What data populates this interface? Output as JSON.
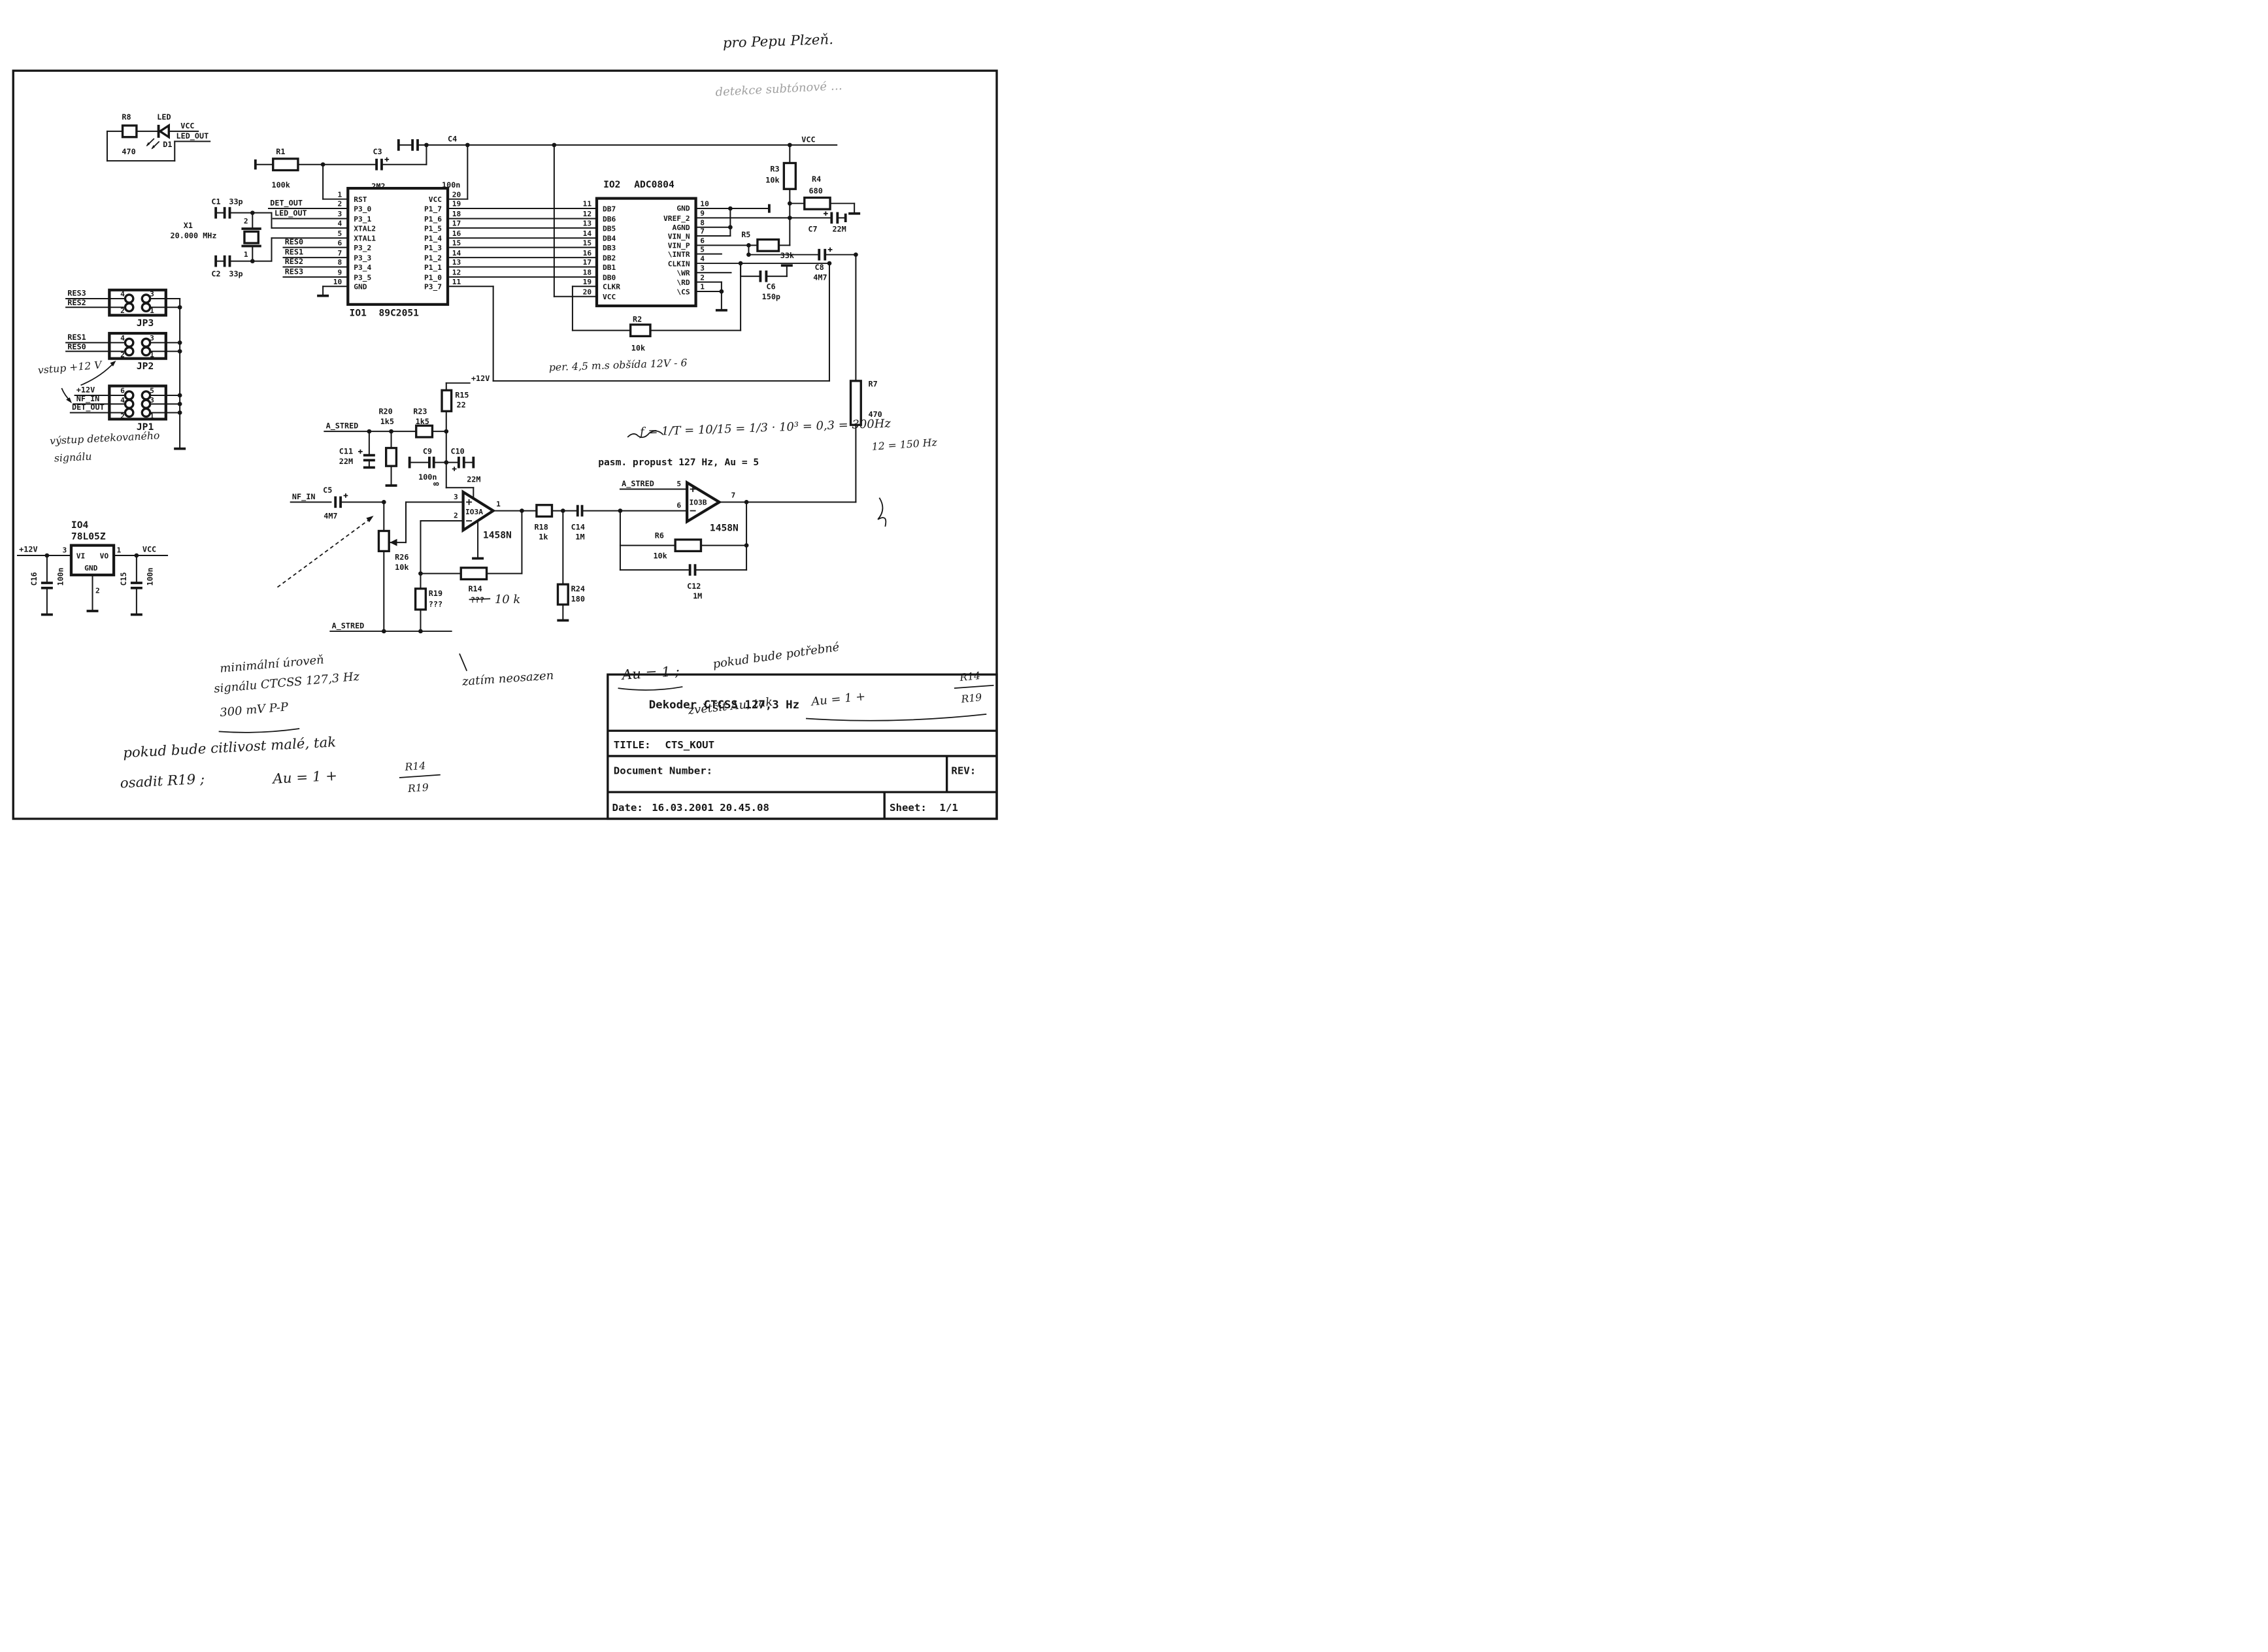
{
  "printed": {
    "bandpass_note": "pasm. propust 127 Hz, Au = 5"
  },
  "handwritten": {
    "dedication": "pro Pepu Plzeň.",
    "note_top": "detekce subtónové …",
    "timing": "per. 4,5 m.s    obšída 12V - 6",
    "formula": "f = 1/T = 10/15 = 1/3 · 10³ = 0,3 = 300Hz",
    "freq": "12 = 150 Hz",
    "r14_value": "10 k",
    "not_fitted": "zatím neosazen",
    "gain1": "Au = 1 ;",
    "gain2": "pokud bude potřebné",
    "gain3": "zvětšit Au, tak",
    "gain4": "Au = 1 +",
    "frac_num": "R14",
    "frac_den": "R19",
    "min1": "minimální úroveň",
    "min2": "signálu CTCSS 127,3 Hz",
    "min3": "300 mV P-P",
    "sens1": "pokud bude citlivost malé, tak",
    "sens2": "osadit R19 ;",
    "sens3": "Au = 1 +",
    "jp_note": "vstup +12 V",
    "out_note1": "výstup detekovaného",
    "out_note2": "signálu"
  },
  "title_block": {
    "name": "Dekoder CTCSS 127,3 Hz",
    "title_label": "TITLE:",
    "title": "CTS_KOUT",
    "doc_label": "Document Number:",
    "rev_label": "REV:",
    "date_label": "Date:",
    "date": "16.03.2001 20.45.08",
    "sheet_label": "Sheet:",
    "sheet": "1/1"
  },
  "nets": {
    "vcc": "VCC",
    "p12": "+12V",
    "led_out": "LED_OUT",
    "det_out": "DET_OUT",
    "res0": "RES0",
    "res1": "RES1",
    "res2": "RES2",
    "res3": "RES3",
    "nf_in": "NF_IN",
    "a_stred": "A_STRED"
  },
  "io1": {
    "ref": "IO1",
    "part": "89C2051",
    "pins_left": [
      {
        "n": "1",
        "label": "RST"
      },
      {
        "n": "2",
        "label": "P3_0"
      },
      {
        "n": "3",
        "label": "P3_1"
      },
      {
        "n": "4",
        "label": "XTAL2"
      },
      {
        "n": "5",
        "label": "XTAL1"
      },
      {
        "n": "6",
        "label": "P3_2"
      },
      {
        "n": "7",
        "label": "P3_3"
      },
      {
        "n": "8",
        "label": "P3_4"
      },
      {
        "n": "9",
        "label": "P3_5"
      },
      {
        "n": "10",
        "label": "GND"
      }
    ],
    "pins_right": [
      {
        "n": "20",
        "label": "VCC"
      },
      {
        "n": "19",
        "label": "P1_7"
      },
      {
        "n": "18",
        "label": "P1_6"
      },
      {
        "n": "17",
        "label": "P1_5"
      },
      {
        "n": "16",
        "label": "P1_4"
      },
      {
        "n": "15",
        "label": "P1_3"
      },
      {
        "n": "14",
        "label": "P1_2"
      },
      {
        "n": "13",
        "label": "P1_1"
      },
      {
        "n": "12",
        "label": "P1_0"
      },
      {
        "n": "11",
        "label": "P3_7"
      }
    ]
  },
  "io2": {
    "ref": "IO2",
    "part": "ADC0804",
    "pins_left": [
      {
        "n": "11",
        "label": "DB7"
      },
      {
        "n": "12",
        "label": "DB6"
      },
      {
        "n": "13",
        "label": "DB5"
      },
      {
        "n": "14",
        "label": "DB4"
      },
      {
        "n": "15",
        "label": "DB3"
      },
      {
        "n": "16",
        "label": "DB2"
      },
      {
        "n": "17",
        "label": "DB1"
      },
      {
        "n": "18",
        "label": "DB0"
      },
      {
        "n": "19",
        "label": "CLKR"
      },
      {
        "n": "20",
        "label": "VCC"
      }
    ],
    "pins_right": [
      {
        "n": "10",
        "label": "GND"
      },
      {
        "n": "9",
        "label": "VREF_2"
      },
      {
        "n": "8",
        "label": "AGND"
      },
      {
        "n": "7",
        "label": "VIN_N"
      },
      {
        "n": "6",
        "label": "VIN_P"
      },
      {
        "n": "5",
        "label": "\\INTR"
      },
      {
        "n": "4",
        "label": "CLKIN"
      },
      {
        "n": "3",
        "label": "\\WR"
      },
      {
        "n": "2",
        "label": "\\RD"
      },
      {
        "n": "1",
        "label": "\\CS"
      }
    ]
  },
  "io3a": {
    "ref": "IO3A",
    "part": "1458N",
    "pin_plus": "3",
    "pin_minus": "2",
    "pin_out": "1",
    "pin_power": "8"
  },
  "io3b": {
    "ref": "IO3B",
    "part": "1458N",
    "pin_plus": "5",
    "pin_minus": "6",
    "pin_out": "7"
  },
  "io4": {
    "ref": "IO4",
    "part": "78L05Z",
    "vi": "VI",
    "vo": "VO",
    "gnd": "GND",
    "pin_in": "3",
    "pin_out": "1",
    "pin_gnd": "2"
  },
  "jumpers": {
    "jp3": {
      "name": "JP3",
      "pins": [
        "4",
        "3",
        "2",
        "1"
      ]
    },
    "jp2": {
      "name": "JP2",
      "pins": [
        "4",
        "3",
        "2",
        "1"
      ]
    },
    "jp1": {
      "name": "JP1",
      "pins": [
        "6",
        "5",
        "4",
        "3",
        "2",
        "1"
      ]
    }
  },
  "components": {
    "r8": {
      "ref": "R8",
      "val": "470"
    },
    "d1": {
      "ref": "D1",
      "label": "LED"
    },
    "r1": {
      "ref": "R1",
      "val": "100k"
    },
    "c3": {
      "ref": "C3",
      "val": "2M2"
    },
    "c4": {
      "ref": "C4",
      "val": "100n"
    },
    "c1": {
      "ref": "C1",
      "val": "33p"
    },
    "c2": {
      "ref": "C2",
      "val": "33p"
    },
    "x1": {
      "ref": "X1",
      "val": "20.000 MHz",
      "pin_top": "2",
      "pin_bot": "1"
    },
    "r2": {
      "ref": "R2",
      "val": "10k"
    },
    "r3": {
      "ref": "R3",
      "val": "10k"
    },
    "r4": {
      "ref": "R4",
      "val": "680"
    },
    "r5": {
      "ref": "R5",
      "val": "33k"
    },
    "c6": {
      "ref": "C6",
      "val": "150p"
    },
    "c7": {
      "ref": "C7",
      "val": "22M"
    },
    "c8": {
      "ref": "C8",
      "val": "4M7"
    },
    "r7": {
      "ref": "R7",
      "val": "470"
    },
    "r15": {
      "ref": "R15",
      "val": "22"
    },
    "r20": {
      "ref": "R20",
      "val": "1k5"
    },
    "r23": {
      "ref": "R23",
      "val": "1k5"
    },
    "c11": {
      "ref": "C11",
      "val": "22M"
    },
    "c9": {
      "ref": "C9",
      "val": "100n"
    },
    "c10": {
      "ref": "C10",
      "val": "22M"
    },
    "c5": {
      "ref": "C5",
      "val": "4M7"
    },
    "r26": {
      "ref": "R26",
      "val": "10k"
    },
    "r19": {
      "ref": "R19",
      "val": "???"
    },
    "r14": {
      "ref": "R14",
      "val": "???"
    },
    "r18": {
      "ref": "R18",
      "val": "1k"
    },
    "c14": {
      "ref": "C14",
      "val": "1M"
    },
    "r24": {
      "ref": "R24",
      "val": "180"
    },
    "r6": {
      "ref": "R6",
      "val": "10k"
    },
    "c12": {
      "ref": "C12",
      "val": "1M"
    },
    "c15": {
      "ref": "C15",
      "val": "100n"
    },
    "c16": {
      "ref": "C16",
      "val": "100n"
    }
  }
}
